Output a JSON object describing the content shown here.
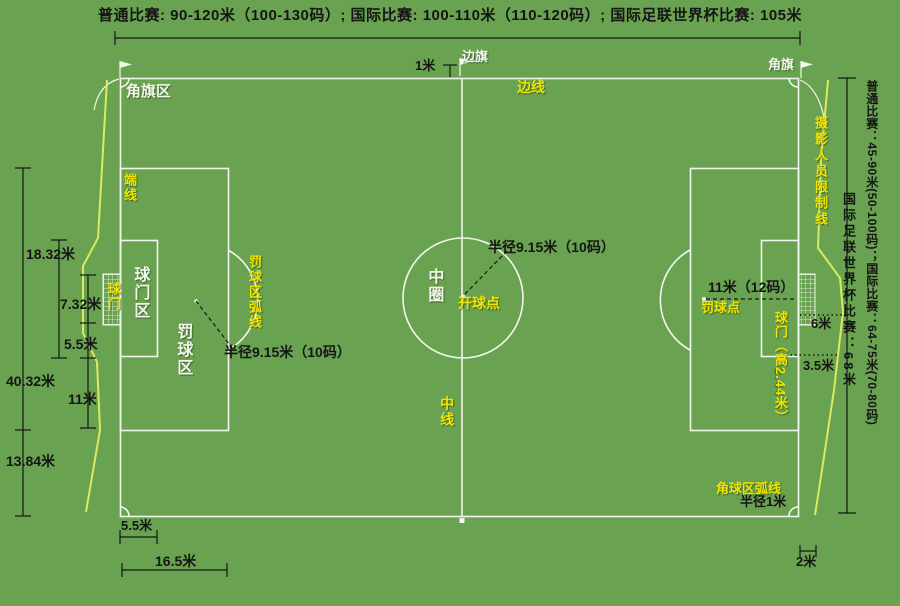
{
  "colors": {
    "grass": "#69a351",
    "line": "#f3f6ec",
    "yellow": "#f2e400",
    "cam": "#dcea5e",
    "ink": "#151515"
  },
  "title": "普通比赛: 90-120米（100-130码）; 国际比赛: 100-110米（110-120码）; 国际足联世界杯比赛: 105米",
  "labels": {
    "corner_flag_area": "角旗区",
    "one_meter": "1米",
    "side_flag": "边旗",
    "touchline": "边线",
    "corner_flag": "角旗",
    "end_line": "端线",
    "goal_area": "球门区",
    "goal_left": "球门",
    "penalty_area": "罚球区",
    "penalty_arc": "罚球区弧线",
    "radius_915_left": "半径9.15米（10码）",
    "center_circle": "中圈",
    "kickoff_point": "开球点",
    "radius_915_center": "半径9.15米（10码）",
    "halfway_line": "中线",
    "eleven_m": "11米（12码）",
    "penalty_spot": "罚球点",
    "goal_height": "球门（高2.44米）",
    "six_m": "6米",
    "three_half_m": "3.5米",
    "corner_arc": "角球区弧线",
    "radius_1m": "半径1米",
    "two_m": "2米",
    "photographer_line": "摄影人员限制线"
  },
  "side_width_note_1": "普通比赛：45-90米(50-100码)；国际比赛：64-75米(70-80码)",
  "side_width_note_2": "国际足联世界杯比赛：68米",
  "dimensions": {
    "d_18_32": "18.32米",
    "d_7_32": "7.32米",
    "d_5_5": "5.5米",
    "d_40_32": "40.32米",
    "d_11": "11米",
    "d_13_84": "13.84米",
    "d_5_5_bottom": "5.5米",
    "d_16_5": "16.5米"
  }
}
